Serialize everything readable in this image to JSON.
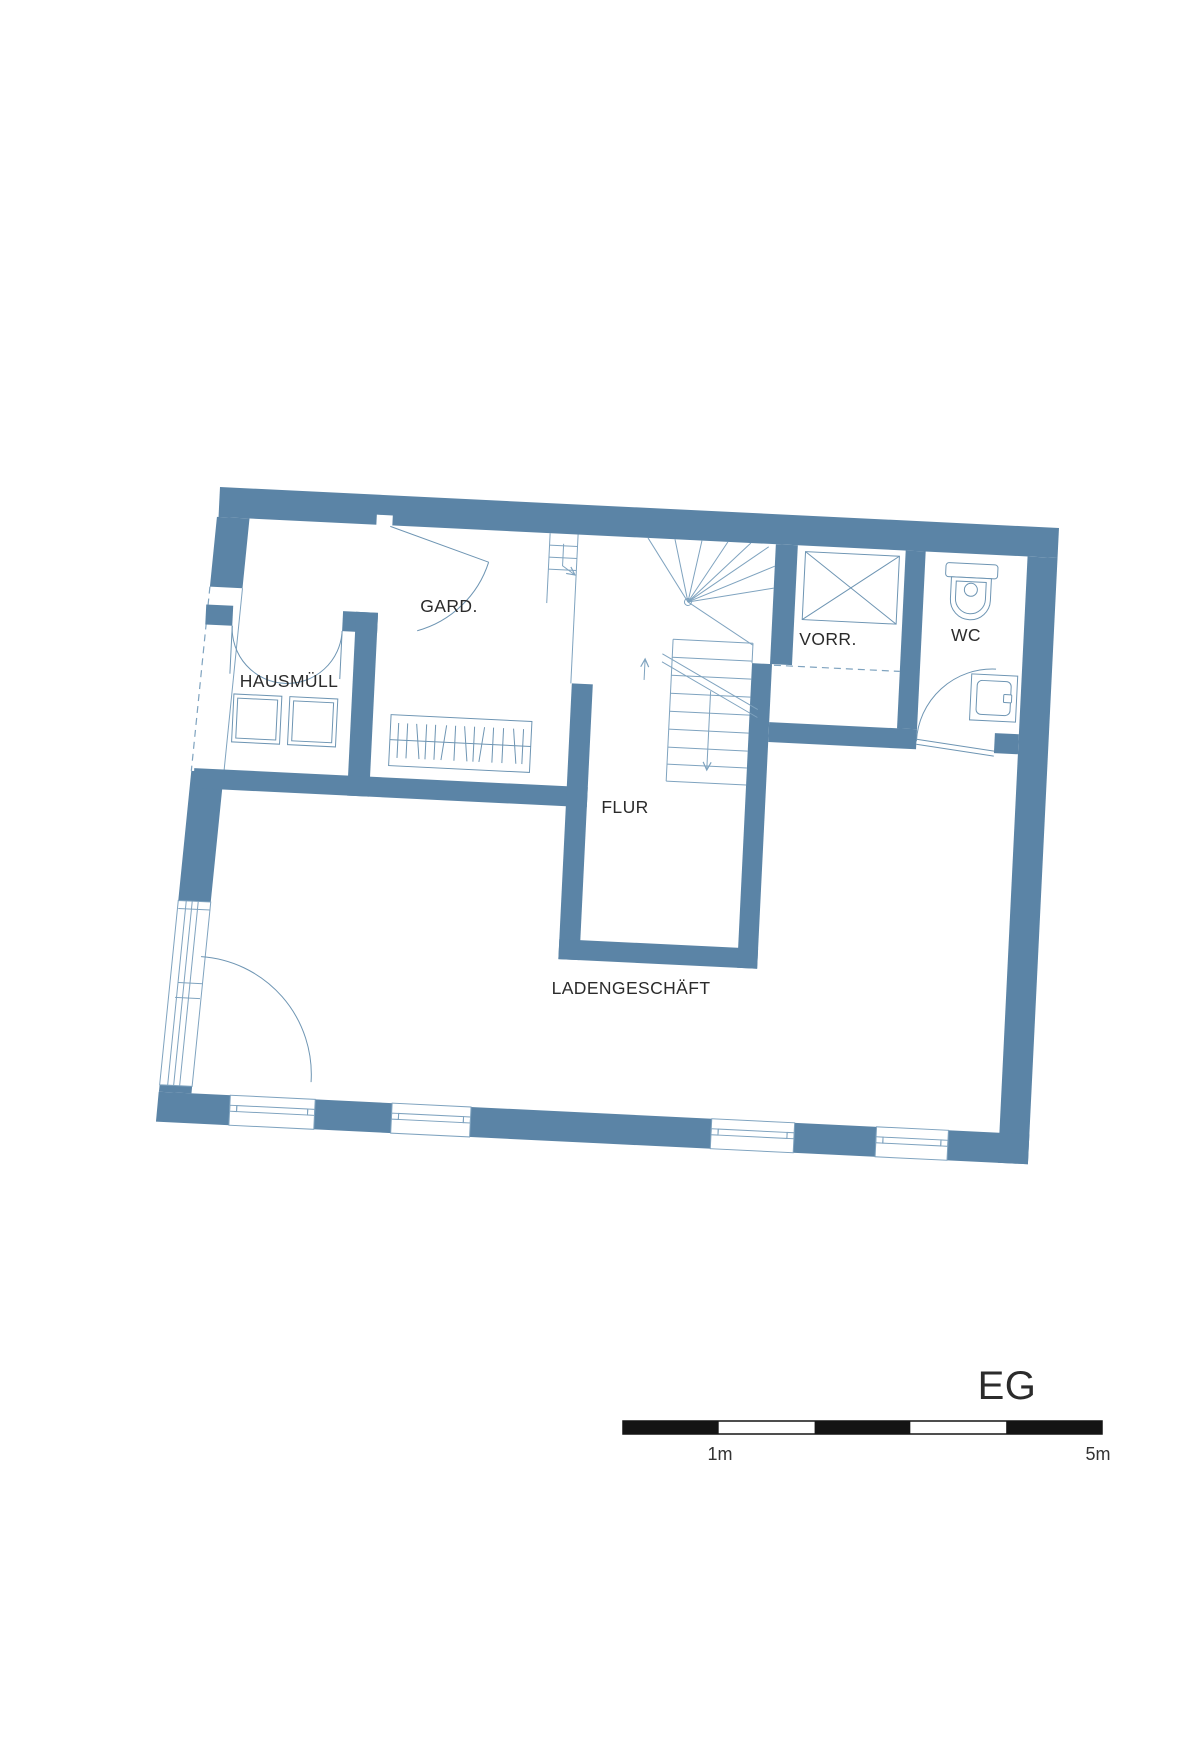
{
  "floor_plan": {
    "floor_label": "EG",
    "room_labels": {
      "hausmuell": "HAUSMÜLL",
      "garderobe": "GARD.",
      "vorrat": "VORR.",
      "wc": "WC",
      "flur": "FLUR",
      "laden": "LADENGESCHÄFT"
    },
    "scale_bar": {
      "label_1m": "1m",
      "label_5m": "5m"
    },
    "colors": {
      "wall_blue": "#5B84A6",
      "thin_line_blue": "#7FA3BF",
      "fixture_line_blue": "#6E95B3",
      "text_dark": "#2B2B2B",
      "scale_bar_black": "#141414",
      "background": "#FFFFFF"
    },
    "fixtures": [
      "waste-bins",
      "wardrobe",
      "winder-stairs",
      "shaft-x-box",
      "toilet",
      "washbasin",
      "entrance-door",
      "double-door",
      "windows"
    ]
  }
}
